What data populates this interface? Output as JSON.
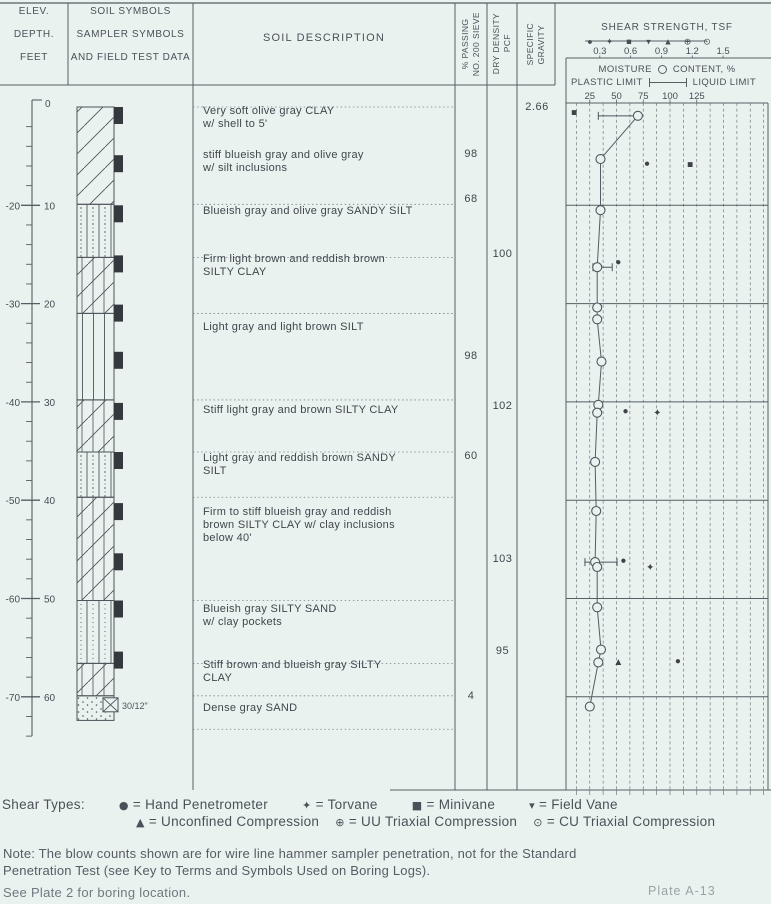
{
  "page": {
    "paper_color": "#eaf2f0",
    "ink_color": "#464d54",
    "line_color": "#565d63",
    "faint_color": "#9aa2a8"
  },
  "header": {
    "col1": [
      "ELEV.",
      "DEPTH.",
      "FEET"
    ],
    "col2": [
      "SOIL SYMBOLS",
      "SAMPLER SYMBOLS",
      "AND FIELD TEST DATA"
    ],
    "col3": "SOIL DESCRIPTION",
    "col4": "% PASSING\nNO. 200 SIEVE",
    "col5": "DRY DENSITY\nPCF",
    "col6": "SPECIFIC\nGRAVITY",
    "shear_title": "SHEAR STRENGTH, TSF",
    "shear_ticks": [
      "0.3",
      "0.6",
      "0.9",
      "1.2",
      "1.5"
    ],
    "moisture_word1": "MOISTURE",
    "moisture_word2": "CONTENT, %",
    "moisture_left": "PLASTIC LIMIT",
    "moisture_right": "LIQUID LIMIT",
    "moisture_ticks": [
      "25",
      "50",
      "75",
      "100",
      "125"
    ]
  },
  "ruler": {
    "top_label": "0",
    "majors": [
      {
        "depth": 10,
        "depth_label": "10",
        "elev_label": "-20"
      },
      {
        "depth": 20,
        "depth_label": "20",
        "elev_label": "-30"
      },
      {
        "depth": 30,
        "depth_label": "30",
        "elev_label": "-40"
      },
      {
        "depth": 40,
        "depth_label": "40",
        "elev_label": "-50"
      },
      {
        "depth": 50,
        "depth_label": "50",
        "elev_label": "-60"
      },
      {
        "depth": 60,
        "depth_label": "60",
        "elev_label": "-70"
      }
    ]
  },
  "log": {
    "layers": [
      {
        "from": 0,
        "to": 9.9,
        "pattern": "clay",
        "soil": "CLAY"
      },
      {
        "from": 9.9,
        "to": 15.3,
        "pattern": "sandy_silt",
        "soil": "SANDY SILT"
      },
      {
        "from": 15.3,
        "to": 21.0,
        "pattern": "silty_clay",
        "soil": "SILTY CLAY"
      },
      {
        "from": 21.0,
        "to": 29.8,
        "pattern": "silt",
        "soil": "SILT"
      },
      {
        "from": 29.8,
        "to": 35.1,
        "pattern": "silty_clay",
        "soil": "SILTY CLAY"
      },
      {
        "from": 35.1,
        "to": 39.7,
        "pattern": "sandy_silt",
        "soil": "SANDY SILT"
      },
      {
        "from": 39.7,
        "to": 50.2,
        "pattern": "silty_clay",
        "soil": "SILTY CLAY"
      },
      {
        "from": 50.2,
        "to": 56.6,
        "pattern": "silty_sand",
        "soil": "SILTY SAND"
      },
      {
        "from": 56.6,
        "to": 59.9,
        "pattern": "silty_clay",
        "soil": "SILTY CLAY"
      },
      {
        "from": 59.9,
        "to": 62.4,
        "pattern": "sand",
        "soil": "SAND"
      }
    ],
    "boundaries": [
      0,
      9.9,
      15.3,
      21.0,
      29.8,
      35.1,
      39.7,
      50.2,
      56.6,
      59.9,
      63.3
    ],
    "descriptions": [
      {
        "depth": 0.2,
        "text": "Very soft olive gray CLAY\nw/ shell to 5'"
      },
      {
        "depth": 4.7,
        "text": "stiff blueish gray and olive gray\nw/ silt inclusions"
      },
      {
        "depth": 10.4,
        "text": "Blueish gray and olive gray SANDY SILT"
      },
      {
        "depth": 15.3,
        "text": "Firm light brown and reddish brown\nSILTY CLAY"
      },
      {
        "depth": 22.2,
        "text": "Light gray and light brown SILT"
      },
      {
        "depth": 30.6,
        "text": "Stiff light gray and brown SILTY CLAY"
      },
      {
        "depth": 35.5,
        "text": "Light gray and reddish brown SANDY\nSILT"
      },
      {
        "depth": 41.0,
        "text": "Firm to stiff blueish gray and reddish\nbrown SILTY CLAY w/ clay inclusions\nbelow 40'"
      },
      {
        "depth": 50.9,
        "text": "Blueish gray SILTY SAND\nw/ clay pockets"
      },
      {
        "depth": 56.6,
        "text": "Stiff brown and blueish gray SILTY\nCLAY"
      },
      {
        "depth": 60.9,
        "text": "Dense gray SAND"
      }
    ],
    "sampler_depths": [
      0,
      4.9,
      10,
      15.1,
      20.1,
      24.9,
      30.1,
      35.1,
      40.3,
      45.4,
      50.2,
      55.4
    ],
    "bottom_sampler": {
      "depth": 60,
      "blow_count": "30/12\""
    }
  },
  "values": {
    "pct_passing": [
      {
        "depth": 4.9,
        "value": "98"
      },
      {
        "depth": 9.5,
        "value": "68"
      },
      {
        "depth": 25.4,
        "value": "98"
      },
      {
        "depth": 35.6,
        "value": "60"
      },
      {
        "depth": 60.0,
        "value": "4"
      }
    ],
    "dry_density": [
      {
        "depth": 15.1,
        "value": "100"
      },
      {
        "depth": 30.5,
        "value": "102"
      },
      {
        "depth": 46.1,
        "value": "103"
      },
      {
        "depth": 55.4,
        "value": "95"
      }
    ],
    "specific_gravity": [
      {
        "depth": 0.1,
        "value": "2.66"
      }
    ]
  },
  "chart_data": {
    "type": "scatter",
    "title": "SHEAR STRENGTH, TSF / MOISTURE CONTENT, % vs DEPTH, FEET",
    "shear_axis_ticks": [
      0.3,
      0.6,
      0.9,
      1.2,
      1.5
    ],
    "moisture_axis_ticks": [
      25,
      50,
      75,
      100,
      125
    ],
    "depth_range": [
      0,
      60
    ],
    "grid": "dashed vertical every 12.5 moisture units",
    "moisture_profile": [
      {
        "depth": 0.9,
        "moisture": 70
      },
      {
        "depth": 5.3,
        "moisture": 35
      },
      {
        "depth": 10.5,
        "moisture": 35
      },
      {
        "depth": 16.3,
        "moisture": 32
      },
      {
        "depth": 20.4,
        "moisture": 32
      },
      {
        "depth": 21.6,
        "moisture": 32
      },
      {
        "depth": 25.9,
        "moisture": 36
      },
      {
        "depth": 30.3,
        "moisture": 33
      },
      {
        "depth": 31.1,
        "moisture": 32
      },
      {
        "depth": 36.1,
        "moisture": 30
      },
      {
        "depth": 41.1,
        "moisture": 31
      },
      {
        "depth": 46.3,
        "moisture": 30
      },
      {
        "depth": 46.8,
        "moisture": 32
      },
      {
        "depth": 50.9,
        "moisture": 32
      },
      {
        "depth": 55.2,
        "moisture": 35.5
      },
      {
        "depth": 56.5,
        "moisture": 33
      },
      {
        "depth": 61.0,
        "moisture": 25
      }
    ],
    "plasticity_bars": [
      {
        "depth": 0.9,
        "plastic_limit": 33,
        "liquid_limit": 70
      },
      {
        "depth": 16.3,
        "plastic_limit": 28,
        "liquid_limit": 46
      },
      {
        "depth": 46.3,
        "plastic_limit": 20.5,
        "liquid_limit": 50.5
      }
    ],
    "shear_points": [
      {
        "depth": 0.5,
        "tsf": 0.05,
        "type": "minivane"
      },
      {
        "depth": 5.7,
        "tsf": 0.76,
        "type": "hand_penetrometer"
      },
      {
        "depth": 5.8,
        "tsf": 1.18,
        "type": "minivane"
      },
      {
        "depth": 15.7,
        "tsf": 0.48,
        "type": "hand_penetrometer"
      },
      {
        "depth": 30.9,
        "tsf": 0.55,
        "type": "hand_penetrometer"
      },
      {
        "depth": 31.1,
        "tsf": 0.86,
        "type": "torvane"
      },
      {
        "depth": 46.1,
        "tsf": 0.53,
        "type": "hand_penetrometer"
      },
      {
        "depth": 46.8,
        "tsf": 0.79,
        "type": "torvane"
      },
      {
        "depth": 56.4,
        "tsf": 0.48,
        "type": "unconfined_compression"
      },
      {
        "depth": 56.3,
        "tsf": 1.06,
        "type": "hand_penetrometer"
      }
    ],
    "symbol_glyphs": {
      "hand_penetrometer": "●",
      "torvane": "✦",
      "minivane": "■",
      "field_vane": "▾",
      "unconfined_compression": "▲",
      "uu_triaxial": "⊕",
      "cu_triaxial": "⊙"
    },
    "header_symbol_order": [
      "hand_penetrometer",
      "torvane",
      "minivane",
      "field_vane",
      "unconfined_compression",
      "uu_triaxial",
      "cu_triaxial"
    ]
  },
  "legend": {
    "title": "Shear Types:",
    "row1": [
      {
        "symbol": "●",
        "label": "Hand Penetrometer"
      },
      {
        "symbol": "✦",
        "label": "Torvane"
      },
      {
        "symbol": "■",
        "label": "Minivane"
      },
      {
        "symbol": "▾",
        "label": "Field Vane"
      }
    ],
    "row2": [
      {
        "symbol": "▲",
        "label": "Unconfined Compression"
      },
      {
        "symbol": "⊕",
        "label": "UU Triaxial Compression"
      },
      {
        "symbol": "⊙",
        "label": "CU Triaxial Compression"
      }
    ]
  },
  "notes": {
    "note": "Note: The blow counts shown are for wire line hammer sampler penetration, not for the Standard\nPenetration Test (see Key to Terms and Symbols Used on Boring Logs).",
    "see_plate": "See Plate 2 for boring location.",
    "plate_no": "Plate A-13"
  }
}
